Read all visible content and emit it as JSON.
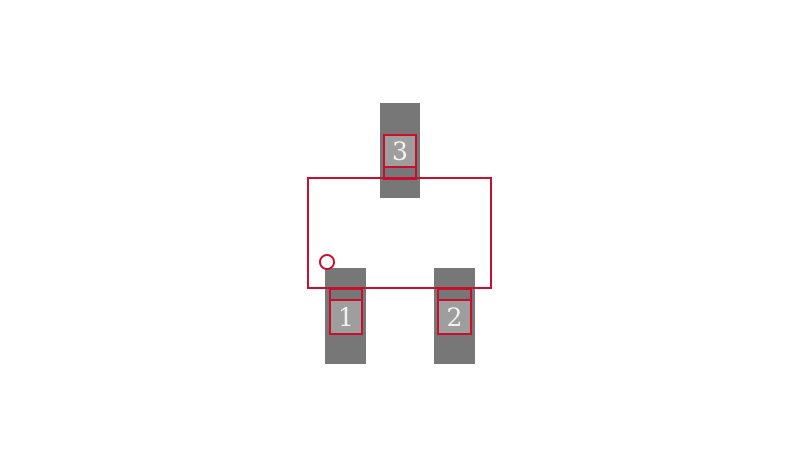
{
  "diagram": {
    "type": "pcb-footprint",
    "package_style": "SOT-23 3-pad land pattern"
  },
  "pins": [
    {
      "number": "1"
    },
    {
      "number": "2"
    },
    {
      "number": "3"
    }
  ],
  "colors": {
    "background": "#ffffff",
    "copper-gray": "#777777",
    "paste-gray": "#9e9e9e",
    "outline-red": "#c8102e",
    "label-white": "#f2f2f2"
  }
}
